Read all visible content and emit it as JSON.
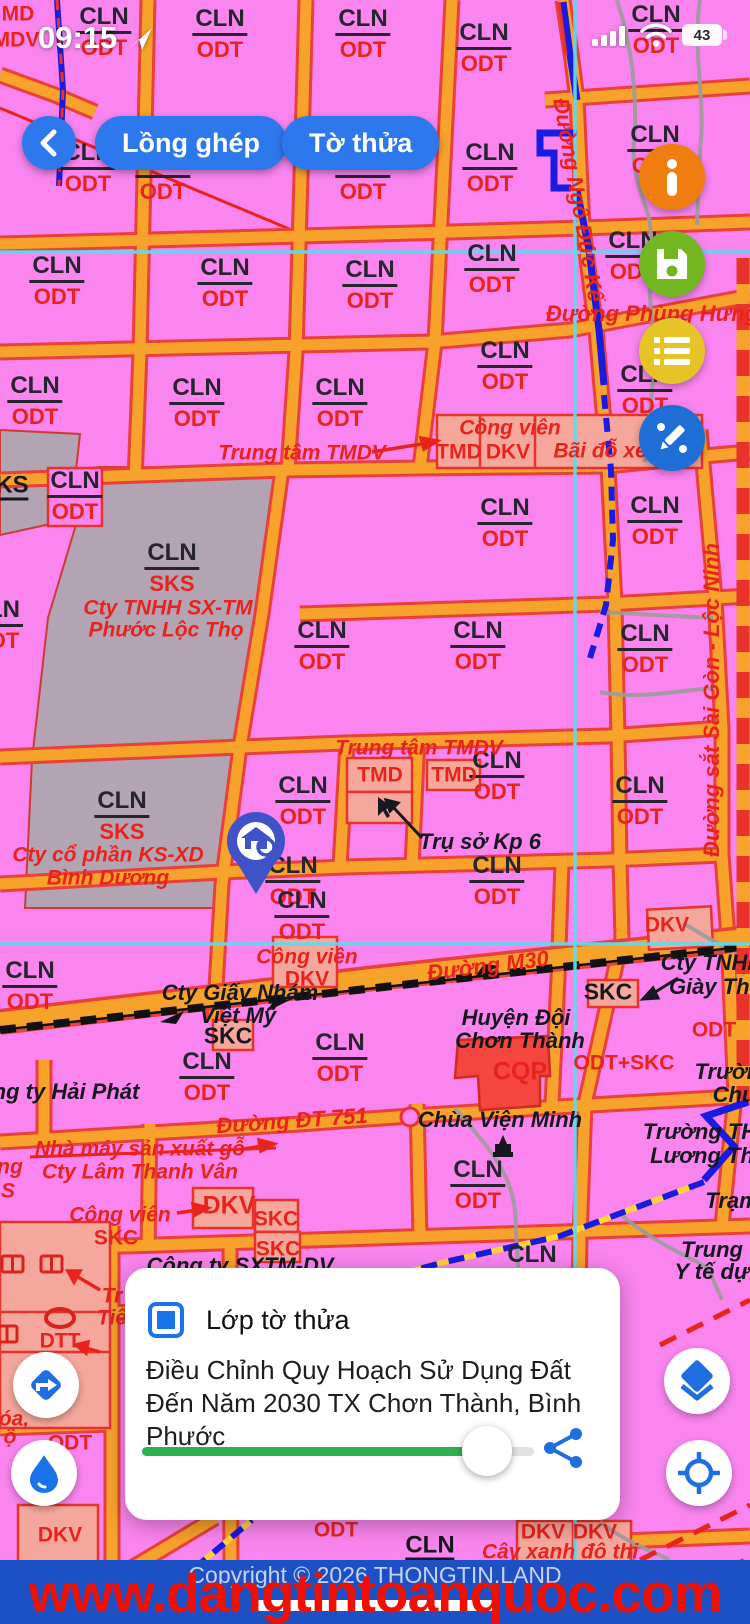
{
  "status_bar": {
    "time": "09:15",
    "battery": "43"
  },
  "toolbar": {
    "overlay_button": "Lồng ghép",
    "parcel_button": "Tờ thửa"
  },
  "layer_card": {
    "title": "Lớp tờ thửa",
    "description": "Điều Chỉnh Quy Hoạch Sử Dụng Đất Đến Năm 2030 TX Chơn Thành, Bình Phước",
    "slider_percent": 88
  },
  "footer": {
    "copyright": "Copyright © 2026 THONGTIN.LAND",
    "watermark": "www.dangtintoanquoc.com"
  },
  "colors": {
    "parcel_pink": "#fa85ef",
    "road_orange": "#f7a22b",
    "road_casing_red": "#e8403a",
    "zone_salmon": "#f5a79c",
    "gray_parcel": "#b3a4b4",
    "military_red": "#f4453e",
    "survey_cyan": "#5fd9ee",
    "boundary_blue": "#1a1ae0",
    "accent_blue": "#2e78ed",
    "fab_info": "#f07d10",
    "fab_save": "#72b622",
    "fab_list": "#e6c427",
    "fab_edit": "#1e6ed6",
    "banner_blue": "#1d50c5",
    "watermark_red": "#ee1103",
    "slider_green": "#2fae52"
  },
  "map": {
    "zones": [
      {
        "t": "CLN",
        "b": "ODT",
        "x": 104,
        "y": 32
      },
      {
        "t": "CLN",
        "b": "ODT",
        "x": 220,
        "y": 34
      },
      {
        "t": "CLN",
        "b": "ODT",
        "x": 363,
        "y": 34
      },
      {
        "t": "CLN",
        "b": "ODT",
        "x": 484,
        "y": 48
      },
      {
        "t": "CLN",
        "b": "ODT",
        "x": 656,
        "y": 30
      },
      {
        "t": "CLN",
        "b": "ODT",
        "x": 88,
        "y": 168
      },
      {
        "t": "CLN",
        "b": "ODT",
        "x": 163,
        "y": 176
      },
      {
        "t": "CLN",
        "b": "ODT",
        "x": 363,
        "y": 176
      },
      {
        "t": "CLN",
        "b": "ODT",
        "x": 490,
        "y": 168
      },
      {
        "t": "CLN",
        "b": "ODT",
        "x": 655,
        "y": 150
      },
      {
        "t": "CLN",
        "b": "ODT",
        "x": 57,
        "y": 281
      },
      {
        "t": "CLN",
        "b": "ODT",
        "x": 225,
        "y": 283
      },
      {
        "t": "CLN",
        "b": "ODT",
        "x": 370,
        "y": 285
      },
      {
        "t": "CLN",
        "b": "ODT",
        "x": 492,
        "y": 269
      },
      {
        "t": "CLN",
        "b": "ODT",
        "x": 633,
        "y": 256
      },
      {
        "t": "CLN",
        "b": "ODT",
        "x": 35,
        "y": 401
      },
      {
        "t": "CLN",
        "b": "ODT",
        "x": 197,
        "y": 403
      },
      {
        "t": "CLN",
        "b": "ODT",
        "x": 340,
        "y": 403
      },
      {
        "t": "CLN",
        "b": "ODT",
        "x": 505,
        "y": 366
      },
      {
        "t": "CLN",
        "b": "ODT",
        "x": 645,
        "y": 390
      },
      {
        "t": "CLN",
        "b": "ODT",
        "x": 75,
        "y": 496
      },
      {
        "t": "CLN",
        "b": "ODT",
        "x": 505,
        "y": 523
      },
      {
        "t": "CLN",
        "b": "ODT",
        "x": 655,
        "y": 521
      },
      {
        "t": "CLN",
        "b": "SKS",
        "x": 172,
        "y": 568
      },
      {
        "t": "LN",
        "b": "OT",
        "x": 4,
        "y": 625
      },
      {
        "t": "CLN",
        "b": "ODT",
        "x": 322,
        "y": 646
      },
      {
        "t": "CLN",
        "b": "ODT",
        "x": 478,
        "y": 646
      },
      {
        "t": "CLN",
        "b": "ODT",
        "x": 645,
        "y": 649
      },
      {
        "t": "CLN",
        "b": "ODT",
        "x": 303,
        "y": 801
      },
      {
        "t": "CLN",
        "b": "ODT",
        "x": 497,
        "y": 776
      },
      {
        "t": "CLN",
        "b": "ODT",
        "x": 640,
        "y": 801
      },
      {
        "t": "CLN",
        "b": "SKS",
        "x": 122,
        "y": 816
      },
      {
        "t": "CLN",
        "b": "ODT",
        "x": 293,
        "y": 881
      },
      {
        "t": "CLN",
        "b": "ODT",
        "x": 497,
        "y": 881
      },
      {
        "t": "CLN",
        "b": "ODT",
        "x": 302,
        "y": 916
      },
      {
        "t": "CLN",
        "b": "ODT",
        "x": 30,
        "y": 986
      },
      {
        "t": "CLN",
        "b": "ODT",
        "x": 340,
        "y": 1058
      },
      {
        "t": "CLN",
        "b": "ODT",
        "x": 207,
        "y": 1077
      },
      {
        "t": "CLN",
        "b": "ODT",
        "x": 478,
        "y": 1185
      },
      {
        "t": "CLN",
        "b": "ODT",
        "x": 532,
        "y": 1270
      }
    ],
    "labels": [
      {
        "text": "MD",
        "x": 18,
        "y": 14,
        "cls": "red"
      },
      {
        "text": "MDV",
        "x": 16,
        "y": 40,
        "cls": "red"
      },
      {
        "text": "Đường Ngô Đức Kế",
        "x": 578,
        "y": 200,
        "cls": "roadname",
        "rot": 80
      },
      {
        "text": "Đường Phùng Hưng",
        "x": 652,
        "y": 314,
        "cls": "roadname"
      },
      {
        "text": "Trung tâm TMDV",
        "x": 302,
        "y": 453,
        "cls": "redi"
      },
      {
        "text": "Công viên",
        "x": 510,
        "y": 428,
        "cls": "redi"
      },
      {
        "text": "TMD",
        "x": 459,
        "y": 452,
        "cls": "red"
      },
      {
        "text": "DKV",
        "x": 508,
        "y": 452,
        "cls": "red"
      },
      {
        "text": "Bãi đỗ xe",
        "x": 600,
        "y": 451,
        "cls": "redi"
      },
      {
        "text": "KS",
        "x": 12,
        "y": 487,
        "cls": "blku"
      },
      {
        "text": "Cty TNHH SX-TM",
        "x": 168,
        "y": 608,
        "cls": "redi"
      },
      {
        "text": "Phước Lộc Thọ",
        "x": 166,
        "y": 630,
        "cls": "redi"
      },
      {
        "text": "Đường sắt Sài Gòn - Lộc Ninh",
        "x": 712,
        "y": 700,
        "cls": "roadname",
        "rot": -90
      },
      {
        "text": "Trung tâm TMDV",
        "x": 419,
        "y": 748,
        "cls": "redi"
      },
      {
        "text": "TMD",
        "x": 380,
        "y": 775,
        "cls": "red"
      },
      {
        "text": "TMD",
        "x": 454,
        "y": 775,
        "cls": "red"
      },
      {
        "text": "Trụ sở Kp 6",
        "x": 480,
        "y": 842,
        "cls": "blki"
      },
      {
        "text": "Cty cổ phần KS-XD",
        "x": 108,
        "y": 855,
        "cls": "redi"
      },
      {
        "text": "Bình Dương",
        "x": 108,
        "y": 878,
        "cls": "redi"
      },
      {
        "text": "Công viên",
        "x": 307,
        "y": 957,
        "cls": "redi"
      },
      {
        "text": "DKV",
        "x": 307,
        "y": 979,
        "cls": "red"
      },
      {
        "text": "DKV",
        "x": 667,
        "y": 925,
        "cls": "red"
      },
      {
        "text": "Đường M30",
        "x": 488,
        "y": 966,
        "cls": "roadname",
        "rot": -7
      },
      {
        "text": "Cty TNHH",
        "x": 712,
        "y": 963,
        "cls": "blki"
      },
      {
        "text": "Giày Thô",
        "x": 716,
        "y": 987,
        "cls": "blki"
      },
      {
        "text": "Cty Giấy Nhám",
        "x": 240,
        "y": 993,
        "cls": "blki"
      },
      {
        "text": "Việt Mỹ",
        "x": 238,
        "y": 1016,
        "cls": "blki"
      },
      {
        "text": "SKC",
        "x": 608,
        "y": 992,
        "cls": "blkb"
      },
      {
        "text": "SKC",
        "x": 228,
        "y": 1036,
        "cls": "blkb"
      },
      {
        "text": "Huyện Đội",
        "x": 516,
        "y": 1018,
        "cls": "blki"
      },
      {
        "text": "Chơn Thành",
        "x": 520,
        "y": 1041,
        "cls": "blki"
      },
      {
        "text": "CQP",
        "x": 520,
        "y": 1072,
        "cls": "redb2"
      },
      {
        "text": "ODT+SKC",
        "x": 624,
        "y": 1063,
        "cls": "red"
      },
      {
        "text": "ODT",
        "x": 714,
        "y": 1030,
        "cls": "red"
      },
      {
        "text": "Trường",
        "x": 734,
        "y": 1072,
        "cls": "blki"
      },
      {
        "text": "Chu",
        "x": 734,
        "y": 1095,
        "cls": "blki"
      },
      {
        "text": "ng ty Hải Phát",
        "x": 66,
        "y": 1092,
        "cls": "blki"
      },
      {
        "text": "Đường ĐT 751",
        "x": 292,
        "y": 1121,
        "cls": "roadname",
        "rot": -4
      },
      {
        "text": "Chùa Viện Minh",
        "x": 500,
        "y": 1120,
        "cls": "blki"
      },
      {
        "text": "Trường TH",
        "x": 700,
        "y": 1132,
        "cls": "blki"
      },
      {
        "text": "Lương Th",
        "x": 702,
        "y": 1156,
        "cls": "blki"
      },
      {
        "text": "Nhà máy sản xuất gỗ",
        "x": 140,
        "y": 1149,
        "cls": "redi"
      },
      {
        "text": "Cty Lâm Thanh Vân",
        "x": 140,
        "y": 1172,
        "cls": "redi"
      },
      {
        "text": "ng",
        "x": 10,
        "y": 1167,
        "cls": "redi"
      },
      {
        "text": "S",
        "x": 8,
        "y": 1191,
        "cls": "redi"
      },
      {
        "text": "Trạm",
        "x": 732,
        "y": 1201,
        "cls": "blki"
      },
      {
        "text": "Công viên",
        "x": 120,
        "y": 1215,
        "cls": "redi"
      },
      {
        "text": "DKV",
        "x": 229,
        "y": 1206,
        "cls": "redb2"
      },
      {
        "text": "SKC",
        "x": 276,
        "y": 1219,
        "cls": "red"
      },
      {
        "text": "SKC",
        "x": 278,
        "y": 1249,
        "cls": "red"
      },
      {
        "text": "SKC",
        "x": 116,
        "y": 1238,
        "cls": "red"
      },
      {
        "text": "Trung",
        "x": 712,
        "y": 1250,
        "cls": "blki"
      },
      {
        "text": "Y tế dự",
        "x": 712,
        "y": 1272,
        "cls": "blki"
      },
      {
        "text": "Công ty SXTM-DV",
        "x": 240,
        "y": 1266,
        "cls": "blki"
      },
      {
        "text": "Tr",
        "x": 112,
        "y": 1296,
        "cls": "redi"
      },
      {
        "text": "Tiê",
        "x": 112,
        "y": 1318,
        "cls": "redi"
      },
      {
        "text": "DTT",
        "x": 60,
        "y": 1341,
        "cls": "red"
      },
      {
        "text": "óa,",
        "x": 14,
        "y": 1419,
        "cls": "redi"
      },
      {
        "text": "ộ",
        "x": 10,
        "y": 1437,
        "cls": "redi"
      },
      {
        "text": "ODT",
        "x": 70,
        "y": 1443,
        "cls": "red"
      },
      {
        "text": "DKV",
        "x": 60,
        "y": 1535,
        "cls": "red"
      },
      {
        "text": "ODT",
        "x": 336,
        "y": 1530,
        "cls": "red"
      },
      {
        "text": "CLN",
        "x": 430,
        "y": 1547,
        "cls": "blku"
      },
      {
        "text": "ODT",
        "x": 430,
        "y": 1577,
        "cls": "red"
      },
      {
        "text": "DKV",
        "x": 543,
        "y": 1532,
        "cls": "red"
      },
      {
        "text": "DKV",
        "x": 595,
        "y": 1532,
        "cls": "red"
      },
      {
        "text": "Cây xanh đô thị",
        "x": 560,
        "y": 1552,
        "cls": "redi"
      }
    ]
  }
}
